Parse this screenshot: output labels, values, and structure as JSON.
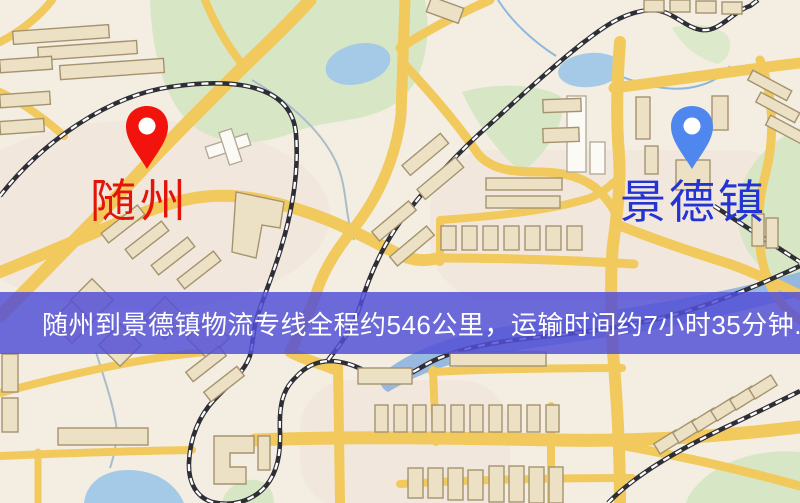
{
  "map": {
    "origin": {
      "label": "随州"
    },
    "destination": {
      "label": "景德镇"
    },
    "banner": {
      "text": "随州到景德镇物流专线全程约546公里，运输时间约7小时35分钟."
    },
    "colors": {
      "map-bg": "#f3eee1",
      "road": "#f1c95d",
      "rail": "#2e2e36",
      "park": "#d7e7c6",
      "water": "#a4cae8",
      "river": "#93b5de",
      "building": "#ece1c5",
      "building-stroke": "#a5936f",
      "banner-bg": "rgba(82,79,214,0.84)",
      "origin-pin": "#f2130d",
      "origin-label": "#e3150b",
      "destination-pin": "#4f87ee",
      "destination-label": "#2434d3"
    },
    "icons": {
      "origin_pin": "map-pin",
      "destination_pin": "map-pin"
    }
  }
}
